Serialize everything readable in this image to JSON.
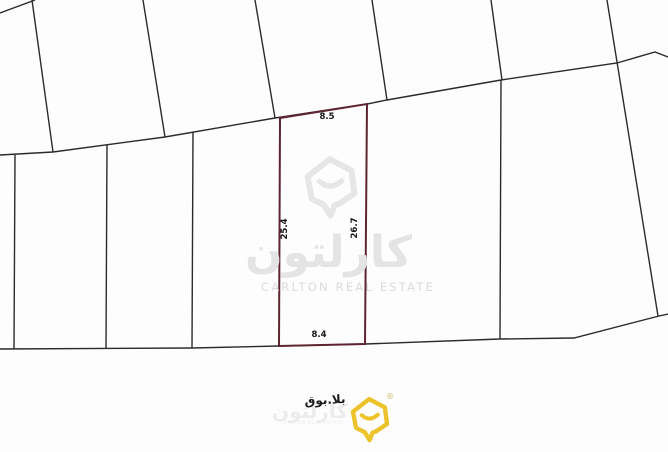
{
  "page": {
    "background": "#fdfdfd"
  },
  "parcel_map": {
    "line_color": "#2b2b2b",
    "boundary_lines": [
      [
        0,
        13,
        35,
        0
      ],
      [
        32,
        0,
        53,
        152
      ],
      [
        143,
        0,
        165,
        137
      ],
      [
        255,
        0,
        275,
        118
      ],
      [
        372,
        0,
        387,
        100
      ],
      [
        491,
        0,
        502,
        80
      ],
      [
        607,
        0,
        658,
        316
      ],
      [
        15,
        155,
        14,
        349
      ],
      [
        107,
        145,
        106,
        349
      ],
      [
        193,
        132,
        192,
        348
      ],
      [
        501,
        80,
        500,
        339
      ]
    ],
    "street_polylines": [
      "0,155 53,152 165,137 275,118 367,104 387,100 501,80 617,63 655,52 668,57",
      "0,349 192,348 279,346 365,344 500,339 574,338 659,316 668,314"
    ]
  },
  "highlighted_plot": {
    "outline_color": "#5d2531",
    "points": "280,118 367,104 365,344 279,346",
    "dimension_labels": [
      {
        "text": "8.5",
        "x": 327,
        "y": 119,
        "rotate": 0,
        "side": "top"
      },
      {
        "text": "25.4",
        "x": 287,
        "y": 229,
        "rotate": -90,
        "side": "left"
      },
      {
        "text": "26.7",
        "x": 357,
        "y": 228,
        "rotate": -90,
        "side": "right"
      },
      {
        "text": "8.4",
        "x": 319,
        "y": 337,
        "rotate": 0,
        "side": "bottom"
      }
    ]
  },
  "center_watermark": {
    "arabic_wordmark": "كارلتون",
    "english_wordmark": "CARLTON REAL ESTATE",
    "color": "#e4e4e4"
  },
  "footer": {
    "annotation_arabic": "بلا.بوق",
    "watermark_arabic": "كارلتون",
    "watermark_english": "CARLTON REAL ESTATE",
    "registered_mark": "®",
    "logo_color": "#ecc32b"
  }
}
